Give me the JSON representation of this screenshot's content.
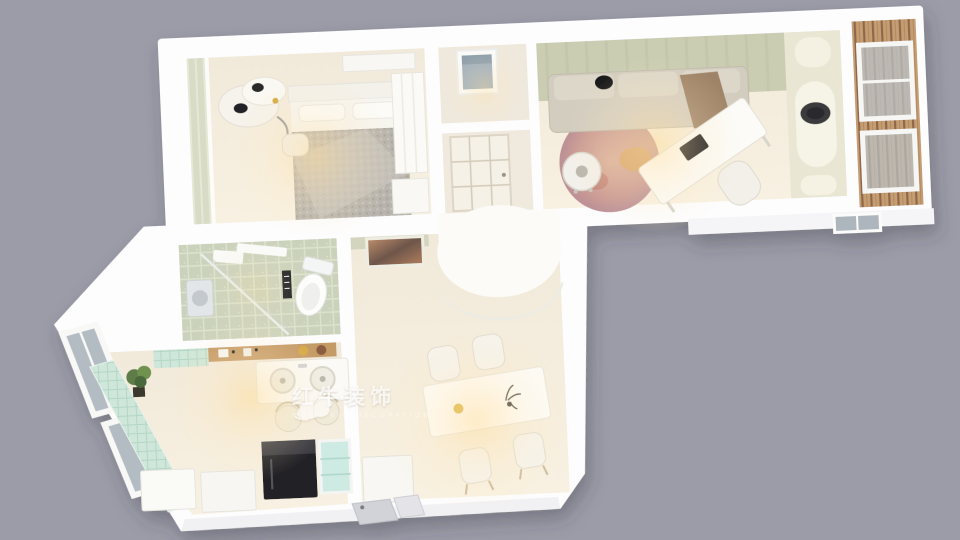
{
  "scene": {
    "kind": "isometric-3d-floorplan-render",
    "background_color": "#9b9ca8",
    "building_color": "#fdfdfe"
  },
  "watermark": {
    "brand": "红牛装饰",
    "brand_latin": "HONG NIU DECORATION",
    "icon": "bull-logo-icon",
    "color": "#ffffff"
  },
  "palette": {
    "wall_white": "#fdfdfe",
    "floor_cream": "#f5eee1",
    "sage_green": "#cacdb2",
    "mint_tile": "#cfe7da",
    "bath_tile": "#cbd2bc",
    "wood_deck": "#c69d72",
    "wood_shelf": "#c49a66",
    "blanket_gray": "#b8b4ad",
    "rug_mauve": "#cf9e8e",
    "glass_gray": "#b4bcc3",
    "appliance_black": "#232327",
    "warm_light": "#ffdf9e"
  },
  "rooms": [
    {
      "name": "bedroom",
      "items": [
        "double-bed",
        "gray-knit-blanket",
        "pillows",
        "headboard",
        "vanity-desk",
        "cow-print-chair",
        "wardrobe",
        "curtain-windows"
      ]
    },
    {
      "name": "inner-bathroom",
      "items": [
        "wall-window",
        "glass-panel-door"
      ]
    },
    {
      "name": "living-study",
      "items": [
        "fabric-sofa",
        "black-round-pillow",
        "throw-blanket",
        "round-rug",
        "coffee-table",
        "writing-desk",
        "desk-chair",
        "laptop"
      ]
    },
    {
      "name": "arch-nook",
      "items": [
        "arched-niches",
        "pet-bed"
      ]
    },
    {
      "name": "balcony",
      "items": [
        "wood-deck",
        "window-frames"
      ]
    },
    {
      "name": "bathroom",
      "items": [
        "toilet",
        "shower-glass-screen",
        "washer",
        "wall-shelf"
      ]
    },
    {
      "name": "kitchen",
      "items": [
        "wood-shelf",
        "mint-tile-counter",
        "double-sink",
        "bar-chairs",
        "fridge",
        "glass-cabinet",
        "cabinets",
        "plant",
        "slanted-bay-windows"
      ]
    },
    {
      "name": "dining",
      "items": [
        "dining-table",
        "four-chairs",
        "wall-mirror",
        "curved-column",
        "console-cabinet",
        "entry-door"
      ]
    }
  ]
}
